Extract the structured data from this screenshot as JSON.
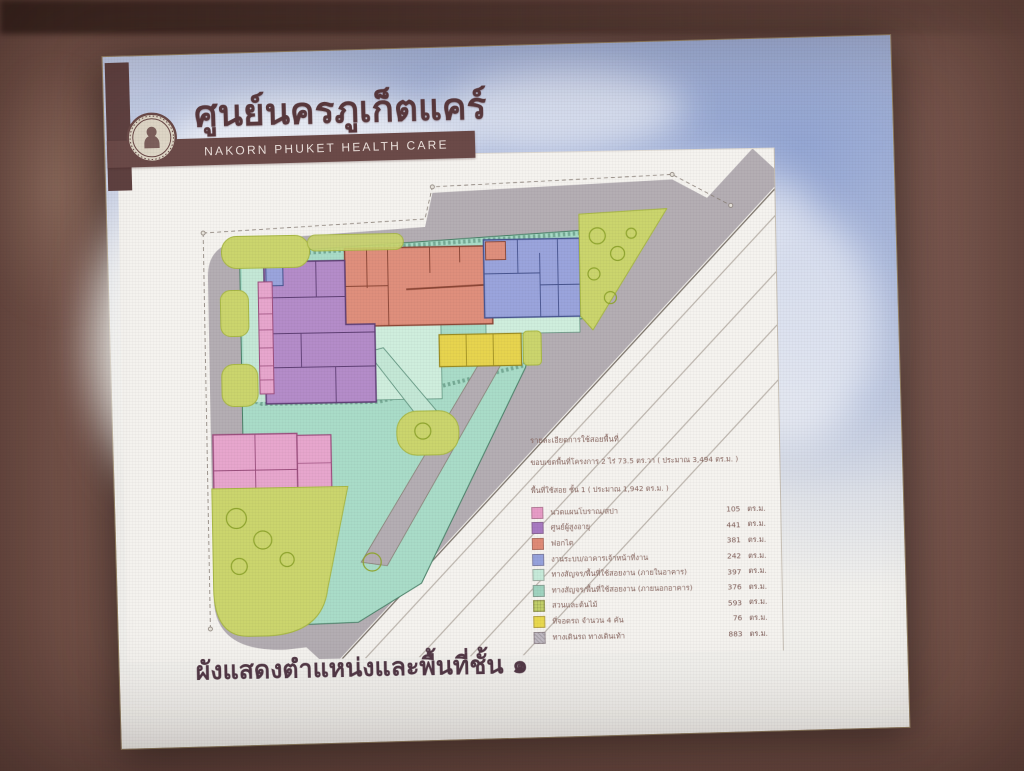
{
  "header": {
    "logo": "nakorn-phuket-seal-icon",
    "title_thai": "ศูนย์นครภูเก็ตแคร์",
    "title_eng": "NAKORN PHUKET HEALTH CARE"
  },
  "plan": {
    "type": "site-plan",
    "floor_label": "ชั้น 1"
  },
  "legend": {
    "title": "รายละเอียดการใช้สอยพื้นที่",
    "subtitle": "ขอบเขตพื้นที่โครงการ 2 ไร่ 73.5 ตร.วา ( ประมาณ 3,494 ตร.ม. )",
    "floor_line": "พื้นที่ใช้สอย ชั้น 1 ( ประมาณ 1,942 ตร.ม. )",
    "unit": "ตร.ม.",
    "items": [
      {
        "label": "นวดแผนโบราณ/สปา",
        "value": "105",
        "color": "#e79cc6"
      },
      {
        "label": "ศูนย์ผู้สูงอายุ",
        "value": "441",
        "color": "#a87ac2"
      },
      {
        "label": "ฟอกไต",
        "value": "381",
        "color": "#df8a76"
      },
      {
        "label": "งานระบบ/อาคารเจ้าหน้าที่งาน",
        "value": "242",
        "color": "#96a2dc"
      },
      {
        "label": "ทางสัญจร/พื้นที่ใช้สอยงาน (ภายในอาคาร)",
        "value": "397",
        "color": "#c6ead9"
      },
      {
        "label": "ทางสัญจร/พื้นที่ใช้สอยงาน (ภายนอกอาคาร)",
        "value": "376",
        "color": "#9fd3bf"
      },
      {
        "label": "สวนและต้นไม้",
        "value": "593",
        "color": "#c3d169"
      },
      {
        "label": "ที่จอดรถ จำนวน 4 คัน",
        "value": "76",
        "color": "#e8d84e"
      },
      {
        "label": "ทางเดินรถ ทางเดินเท้า",
        "value": "883",
        "color": "#c0bac2"
      }
    ]
  },
  "caption": "ผังแสดงตำแหน่งและพื้นที่ชั้น ๑"
}
